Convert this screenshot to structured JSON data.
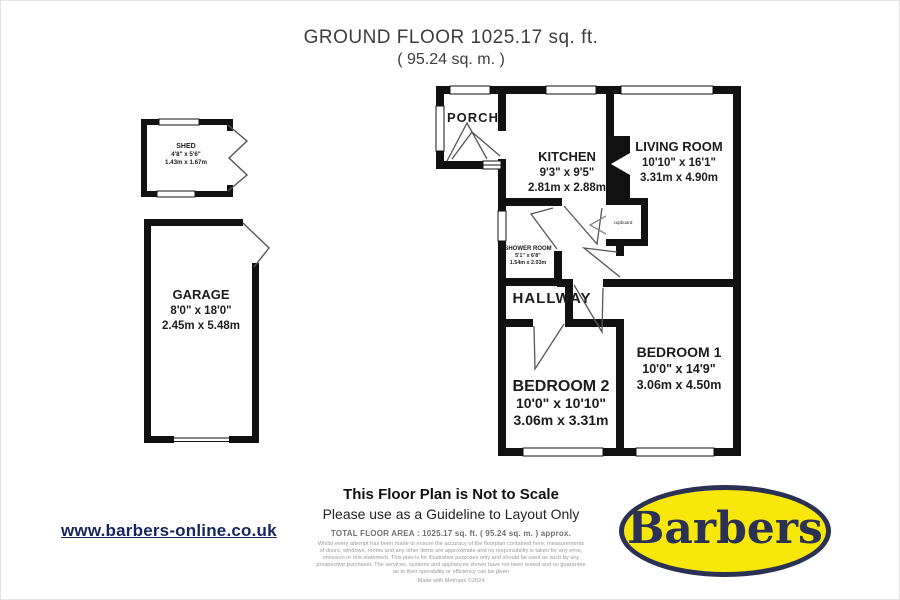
{
  "title": {
    "line1": "GROUND FLOOR 1025.17 sq. ft.",
    "line2": "( 95.24 sq. m. )"
  },
  "rooms": {
    "shed": {
      "name": "SHED",
      "imperial": "4'8\" x 5'6\"",
      "metric": "1.43m x 1.67m"
    },
    "garage": {
      "name": "GARAGE",
      "imperial": "8'0\" x 18'0\"",
      "metric": "2.45m x 5.48m"
    },
    "porch": {
      "name": "PORCH"
    },
    "kitchen": {
      "name": "KITCHEN",
      "imperial": "9'3\" x 9'5\"",
      "metric": "2.81m x 2.88m"
    },
    "living_room": {
      "name": "LIVING ROOM",
      "imperial": "10'10\" x 16'1\"",
      "metric": "3.31m x 4.90m"
    },
    "shower_room": {
      "name": "SHOWER ROOM",
      "imperial": "5'1\" x 6'8\"",
      "metric": "1.54m x 2.03m"
    },
    "hallway": {
      "name": "HALLWAY"
    },
    "bedroom2": {
      "name": "BEDROOM 2",
      "imperial": "10'0\" x 10'10\"",
      "metric": "3.06m x 3.31m"
    },
    "bedroom1": {
      "name": "BEDROOM 1",
      "imperial": "10'0\" x 14'9\"",
      "metric": "3.06m x 4.50m"
    },
    "cupboard": {
      "name": "cupboard"
    }
  },
  "footer": {
    "not_to_scale": "This Floor Plan is Not to Scale",
    "guideline": "Please use as a Guideline to Layout Only",
    "total_area": "TOTAL FLOOR AREA : 1025.17 sq. ft. ( 95.24 sq. m. ) approx.",
    "disclaimer": "Whilst every attempt has been made to ensure the accuracy of the floorplan contained here, measurements of doors, windows, rooms and any other items are approximate and no responsibility is taken for any error, omission or mis-statement. This plan is for illustrative purposes only and should be used as such by any prospective purchaser. The services, systems and appliances shown have not been tested and no guarantee as to their operability or efficiency can be given",
    "made_with": "Made with Metropix ©2024"
  },
  "branding": {
    "website": "www.barbers-online.co.uk",
    "logo_text": "Barbers",
    "logo_background": "#f8e70a",
    "logo_navy": "#2a3154",
    "link_color": "#16255e"
  }
}
